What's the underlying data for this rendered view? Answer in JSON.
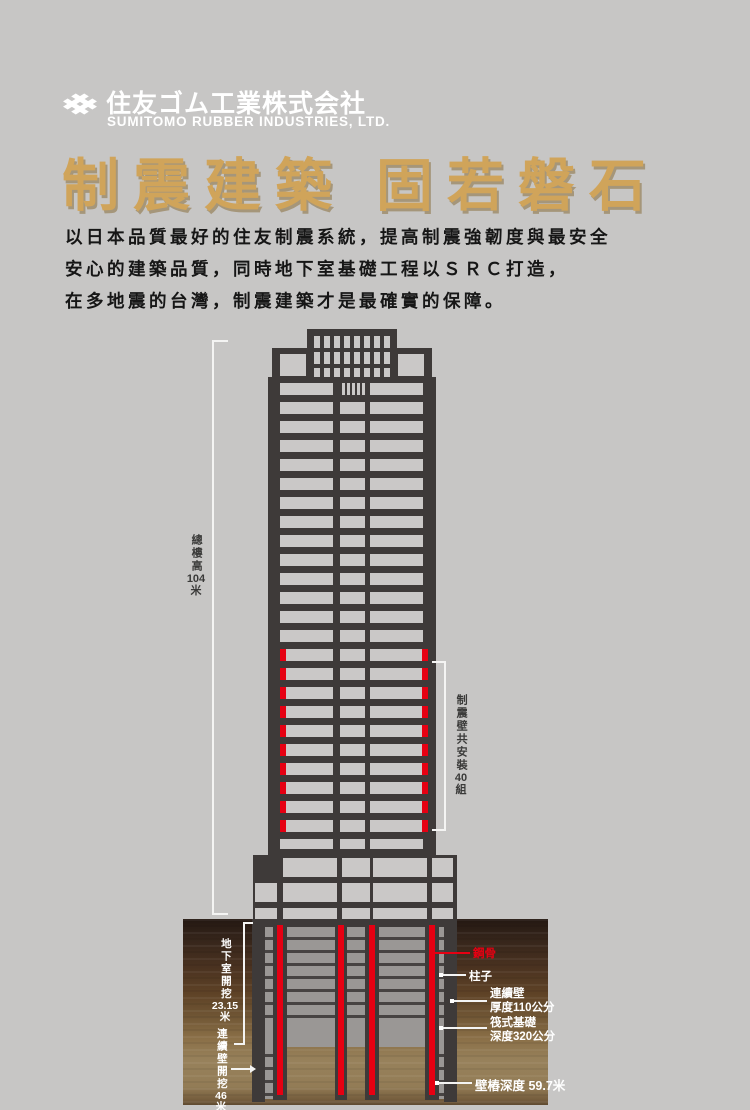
{
  "header": {
    "logo_title": "住友ゴム工業株式会社",
    "logo_subtitle": "SUMITOMO RUBBER INDUSTRIES, LTD.",
    "title": "制震建築 固若磐石",
    "title_color": "#d0a45a",
    "body_lines": [
      "以日本品質最好的住友制震系統，提高制震強韌度與最安全",
      "安心的建築品質，同時地下室基礎工程以ＳＲＣ打造，",
      "在多地震的台灣，制震建築才是最確實的保障。"
    ]
  },
  "diagram": {
    "colors": {
      "structure_dark": "#3e3a39",
      "window_gray": "#cac8c7",
      "damper_red": "#e60012",
      "basement_gray": "#9a9795"
    },
    "total_height": {
      "label": "總樓高",
      "value": "104",
      "unit": "米"
    },
    "damper_count": {
      "label": "制震壁共安裝",
      "value": "40",
      "unit": "組"
    },
    "basement_excavation": {
      "label": "地下室開挖",
      "value": "23.15",
      "unit": "米"
    },
    "wall_excavation": {
      "label": "連續壁開挖",
      "value": "46",
      "unit": "米"
    },
    "steel_label": "鋼骨",
    "column_label": "柱子",
    "diaphragm_wall": {
      "line1": "連續壁",
      "line2": "厚度110公分"
    },
    "raft_foundation": {
      "line1": "筏式基礎",
      "line2": "深度320公分"
    },
    "pile_depth_label": "壁樁深度 59.7米"
  }
}
